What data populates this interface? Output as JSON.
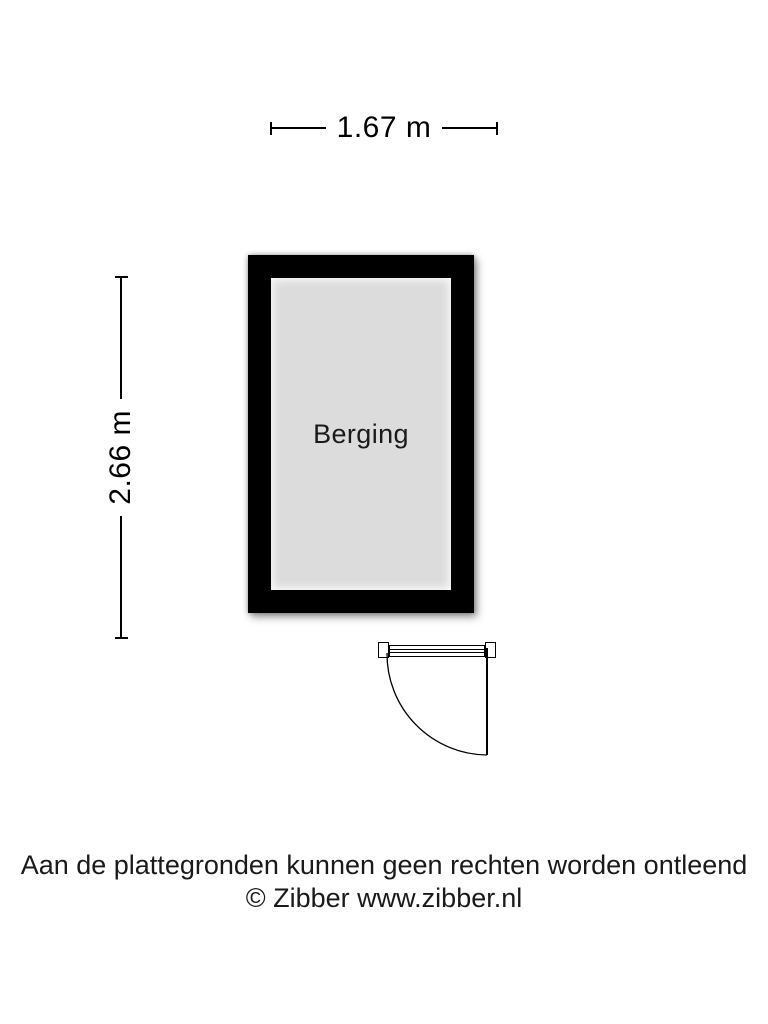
{
  "floorplan": {
    "room_label": "Berging",
    "width_label": "1.67 m",
    "height_label": "2.66 m"
  },
  "footer": {
    "disclaimer": "Aan de plattegronden kunnen geen rechten worden ontleend",
    "copyright": "© Zibber www.zibber.nl"
  },
  "colors": {
    "wall": "#000000",
    "floor": "#dcdcdc",
    "line": "#000000",
    "text": "#1a1a1a"
  }
}
